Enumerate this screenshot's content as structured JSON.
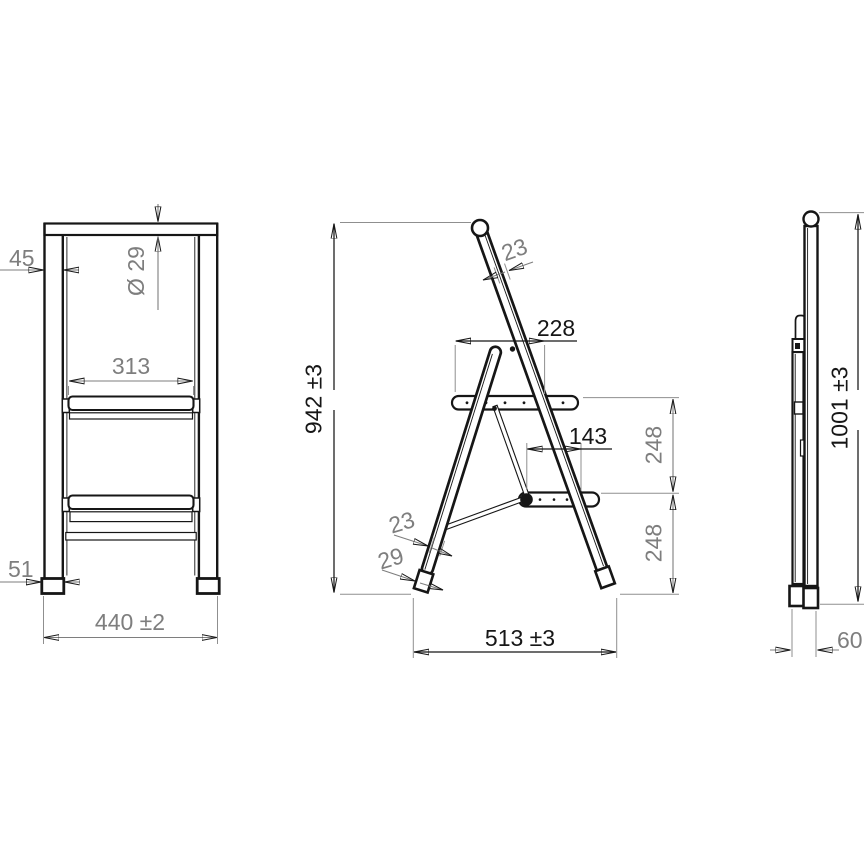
{
  "drawing": {
    "front_view": {
      "leg_width": "45",
      "handle_tube_diameter": "Ø 29",
      "step_clear_width": "313",
      "foot_width": "51",
      "overall_width": "440 ±2"
    },
    "side_view": {
      "rail_profile_upper": "23",
      "platform_depth": "228",
      "open_height": "942 ±3",
      "brace_pivot_offset": "143",
      "upper_step_rise": "248",
      "lower_step_rise": "248",
      "rail_profile_lower": "23",
      "foot_profile_depth": "29",
      "base_footprint": "513 ±3"
    },
    "folded_view": {
      "folded_height": "1001 ±3",
      "folded_depth": "60"
    }
  },
  "colors": {
    "outline": "#161616",
    "dimension_primary": "#161616",
    "dimension_secondary": "#7e7e7e",
    "surface": "#ffffff"
  }
}
